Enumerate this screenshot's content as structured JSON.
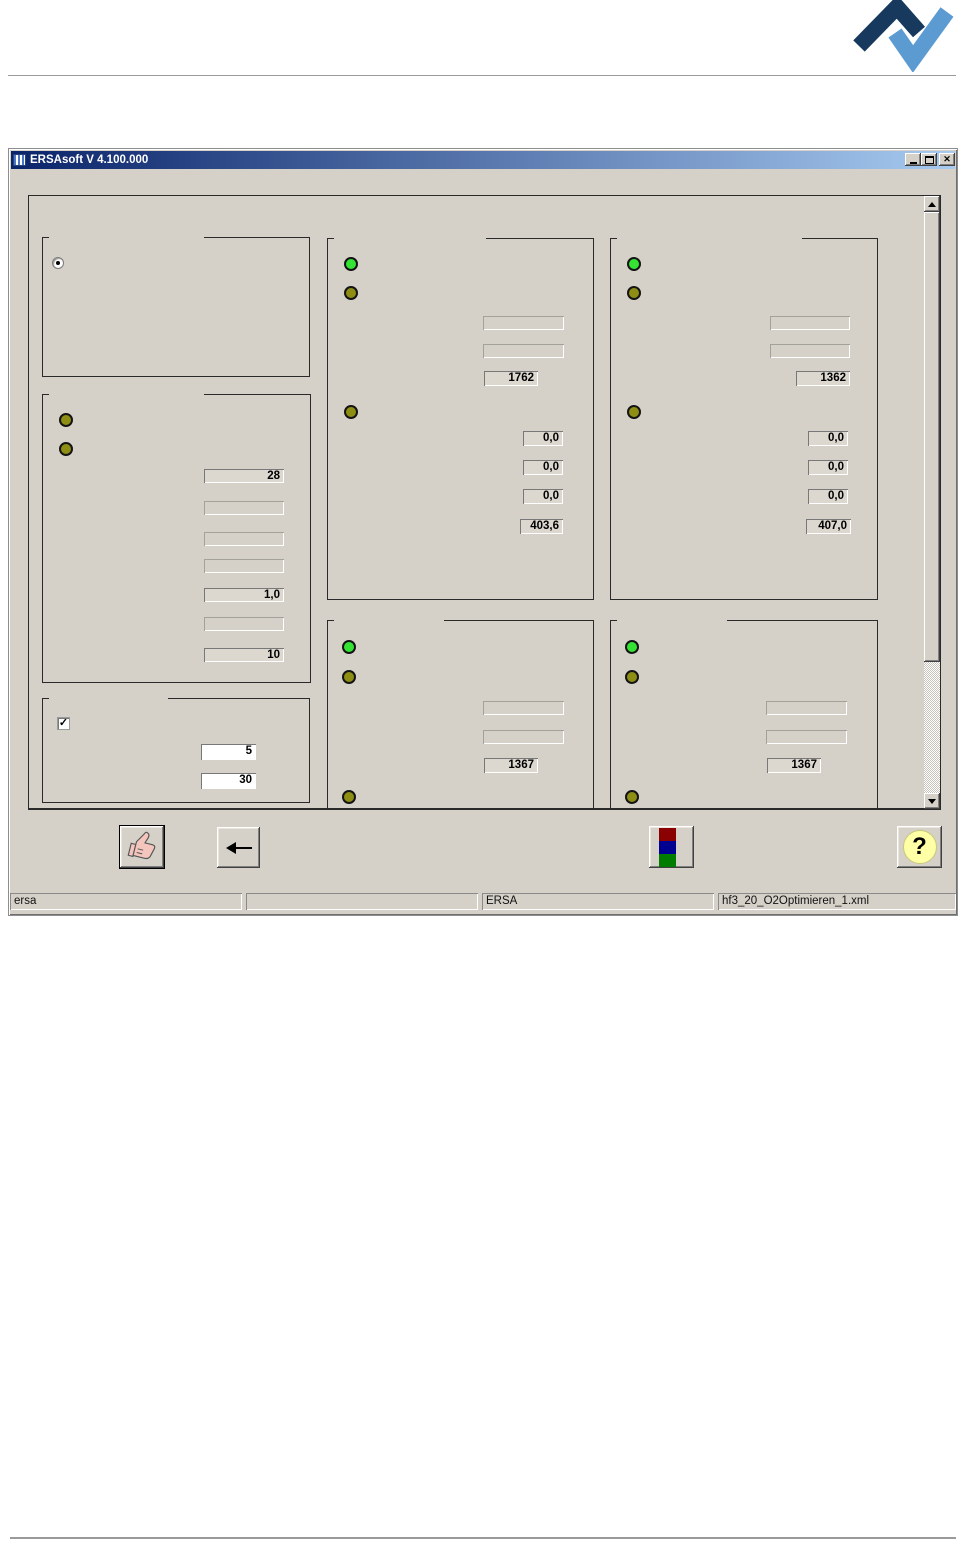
{
  "colors": {
    "titlebar_left": "#0a246a",
    "titlebar_right": "#a6caf0",
    "logo_dark": "#17395e",
    "logo_light": "#5b9bd2",
    "led_green": "#35e335",
    "led_olive": "#8e8e15",
    "square_red": "#8b0000",
    "square_blue": "#000091",
    "square_green": "#007d00",
    "help_circle": "#ffffa6"
  },
  "window": {
    "title": "ERSAsoft V 4.100.000"
  },
  "icons": {
    "close_glyph": "✕",
    "check_glyph": "✓",
    "help_glyph": "?"
  },
  "groups": {
    "selection": {
      "radio_selected": true
    },
    "parameters": {
      "fields": [
        "28",
        "",
        "",
        "",
        "1,0",
        "",
        "10"
      ]
    },
    "options": {
      "checkbox_checked": true,
      "inputs": [
        "5",
        "30"
      ]
    },
    "station_top_left": {
      "empty_fields": [
        "",
        ""
      ],
      "value_main": "1762",
      "readings": [
        "0,0",
        "0,0",
        "0,0",
        "403,6"
      ]
    },
    "station_top_right": {
      "empty_fields": [
        "",
        ""
      ],
      "value_main": "1362",
      "readings": [
        "0,0",
        "0,0",
        "0,0",
        "407,0"
      ]
    },
    "station_bottom_left": {
      "empty_fields": [
        "",
        ""
      ],
      "value_main": "1367"
    },
    "station_bottom_right": {
      "empty_fields": [
        "",
        ""
      ],
      "value_main": "1367"
    }
  },
  "statusbar": {
    "panels": [
      "ersa",
      "",
      "ERSA",
      "hf3_20_O2Optimieren_1.xml"
    ]
  }
}
